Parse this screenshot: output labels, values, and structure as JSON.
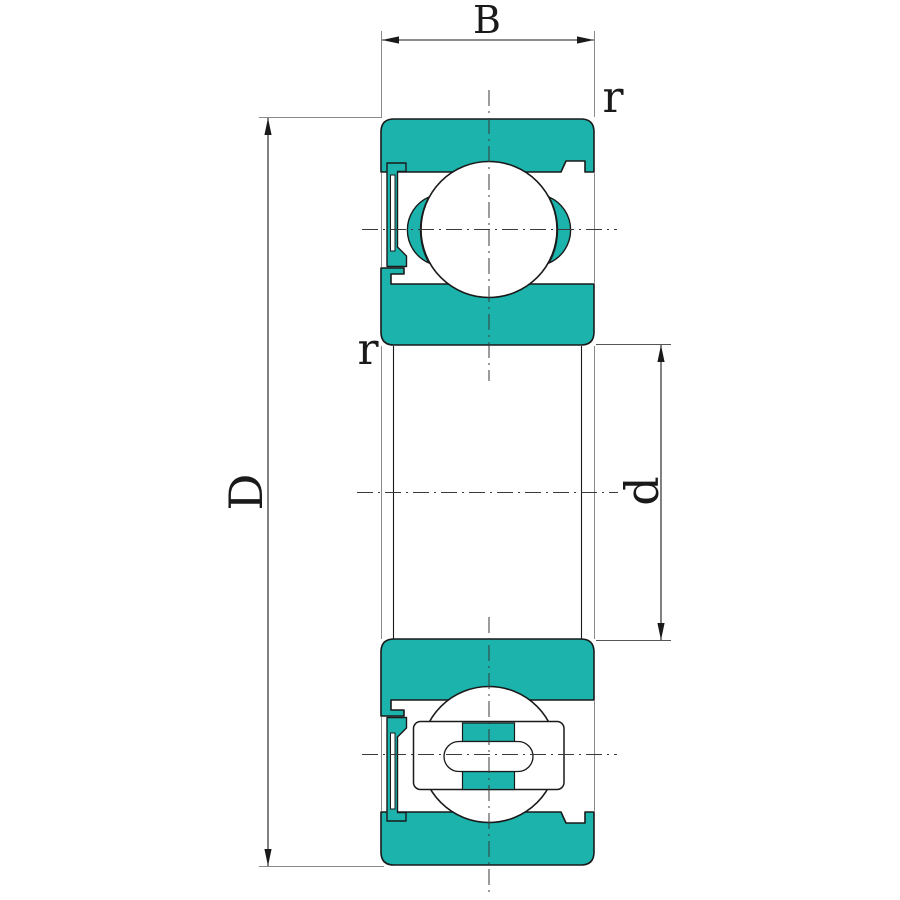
{
  "diagram": {
    "labels": {
      "width": "B",
      "outer_diameter": "D",
      "bore_diameter": "d",
      "corner_radius_outer": "r",
      "corner_radius_inner": "r"
    },
    "colors": {
      "ring_fill": "#1bb3ac",
      "outline": "#1a1a1a",
      "thin_line": "#8a8a8a",
      "background": "#ffffff"
    }
  }
}
